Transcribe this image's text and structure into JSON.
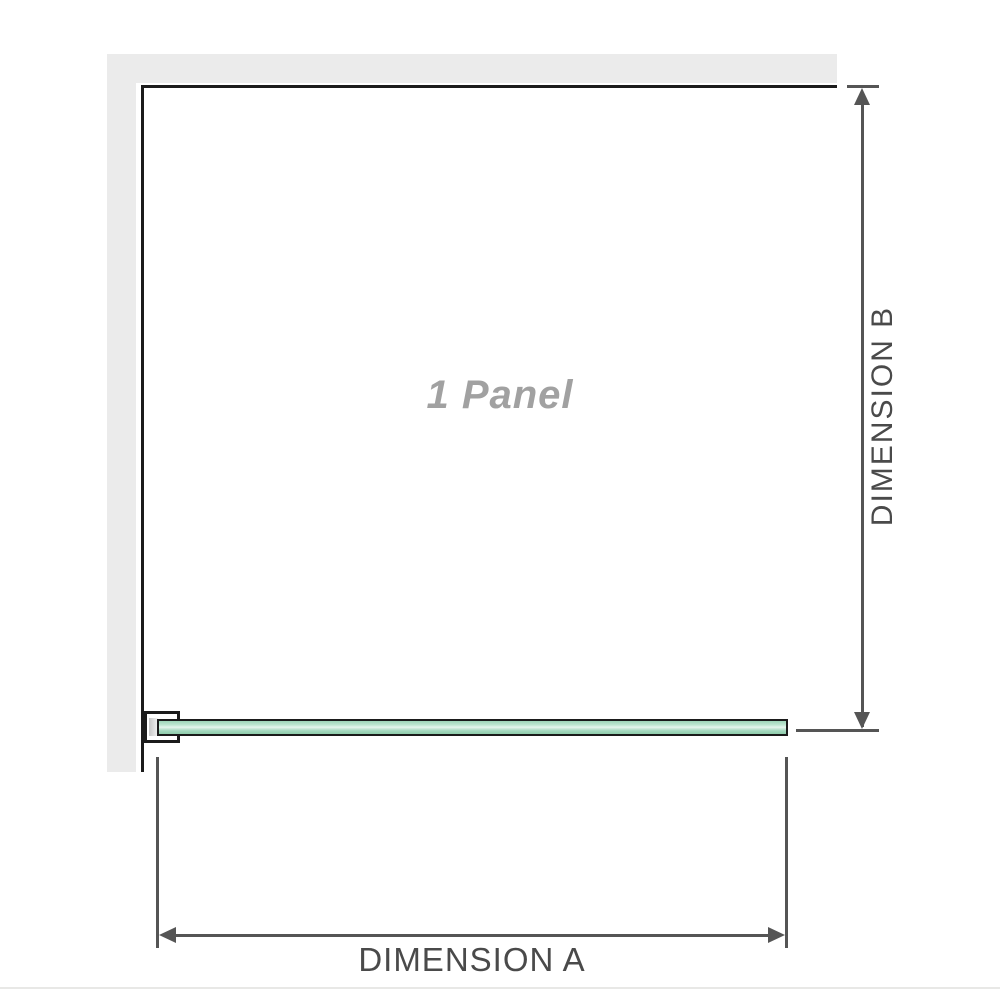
{
  "diagram": {
    "panel": {
      "label": "1 Panel"
    },
    "dimensions": {
      "a": {
        "label": "DIMENSION A"
      },
      "b": {
        "label": "DIMENSION B"
      }
    },
    "colors": {
      "wall_gray": "#ebebeb",
      "outline_black": "#1b1b1b",
      "dimension_lines": "#555555",
      "dimension_text": "#4a4a4a",
      "glass_green": "#a4d8bf",
      "glass_highlight": "#e7f7ee",
      "panel_label_gray": "#a1a1a1",
      "background": "#ffffff"
    }
  }
}
